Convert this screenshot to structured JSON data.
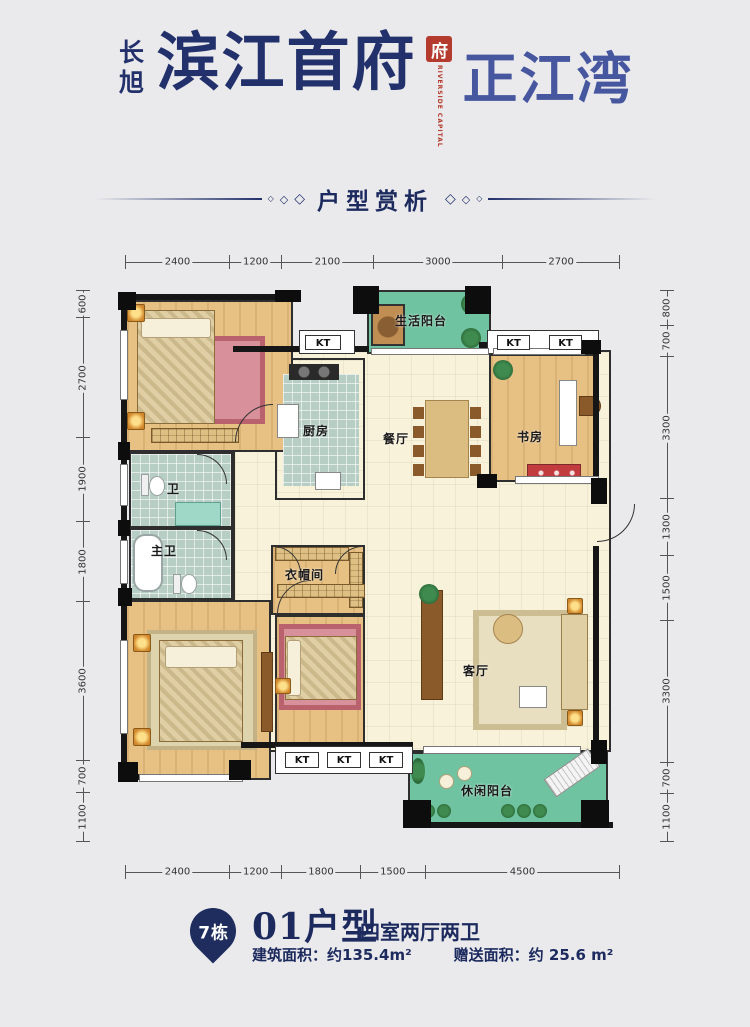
{
  "colors": {
    "navy": "#22306b",
    "light_navy": "#47579f",
    "seal_red": "#b43b2e",
    "balcony_green": "#6fc3a1"
  },
  "header": {
    "brand_vertical": "长旭",
    "title": "滨江首府",
    "seal_char": "府",
    "seal_caption": "RIVERSIDE CAPITAL",
    "subtitle": "正江湾"
  },
  "section": {
    "title": "户型赏析",
    "diamond": "◇"
  },
  "floorplan": {
    "kt_label": "KT",
    "rooms": {
      "life_balcony": "生活阳台",
      "kitchen": "厨房",
      "dining": "餐厅",
      "study": "书房",
      "bath": "卫",
      "master_bath": "主卫",
      "cloakroom": "衣帽间",
      "living": "客厅",
      "leisure_balcony": "休闲阳台"
    },
    "dimensions": {
      "top": [
        "2400",
        "1200",
        "2100",
        "3000",
        "2700"
      ],
      "bottom": [
        "2400",
        "1200",
        "1800",
        "1500",
        "4500"
      ],
      "left": [
        "600",
        "2700",
        "1900",
        "1800",
        "3600",
        "700",
        "1100"
      ],
      "right": [
        "800",
        "700",
        "3300",
        "1300",
        "1500",
        "3300",
        "700",
        "1100"
      ]
    }
  },
  "footer": {
    "building_badge": "7栋",
    "unit_title": "01户型",
    "unit_layout": "四室两厅两卫",
    "area_built": "建筑面积：约135.4m²",
    "area_gift": "赠送面积：约 25.6 m²"
  }
}
